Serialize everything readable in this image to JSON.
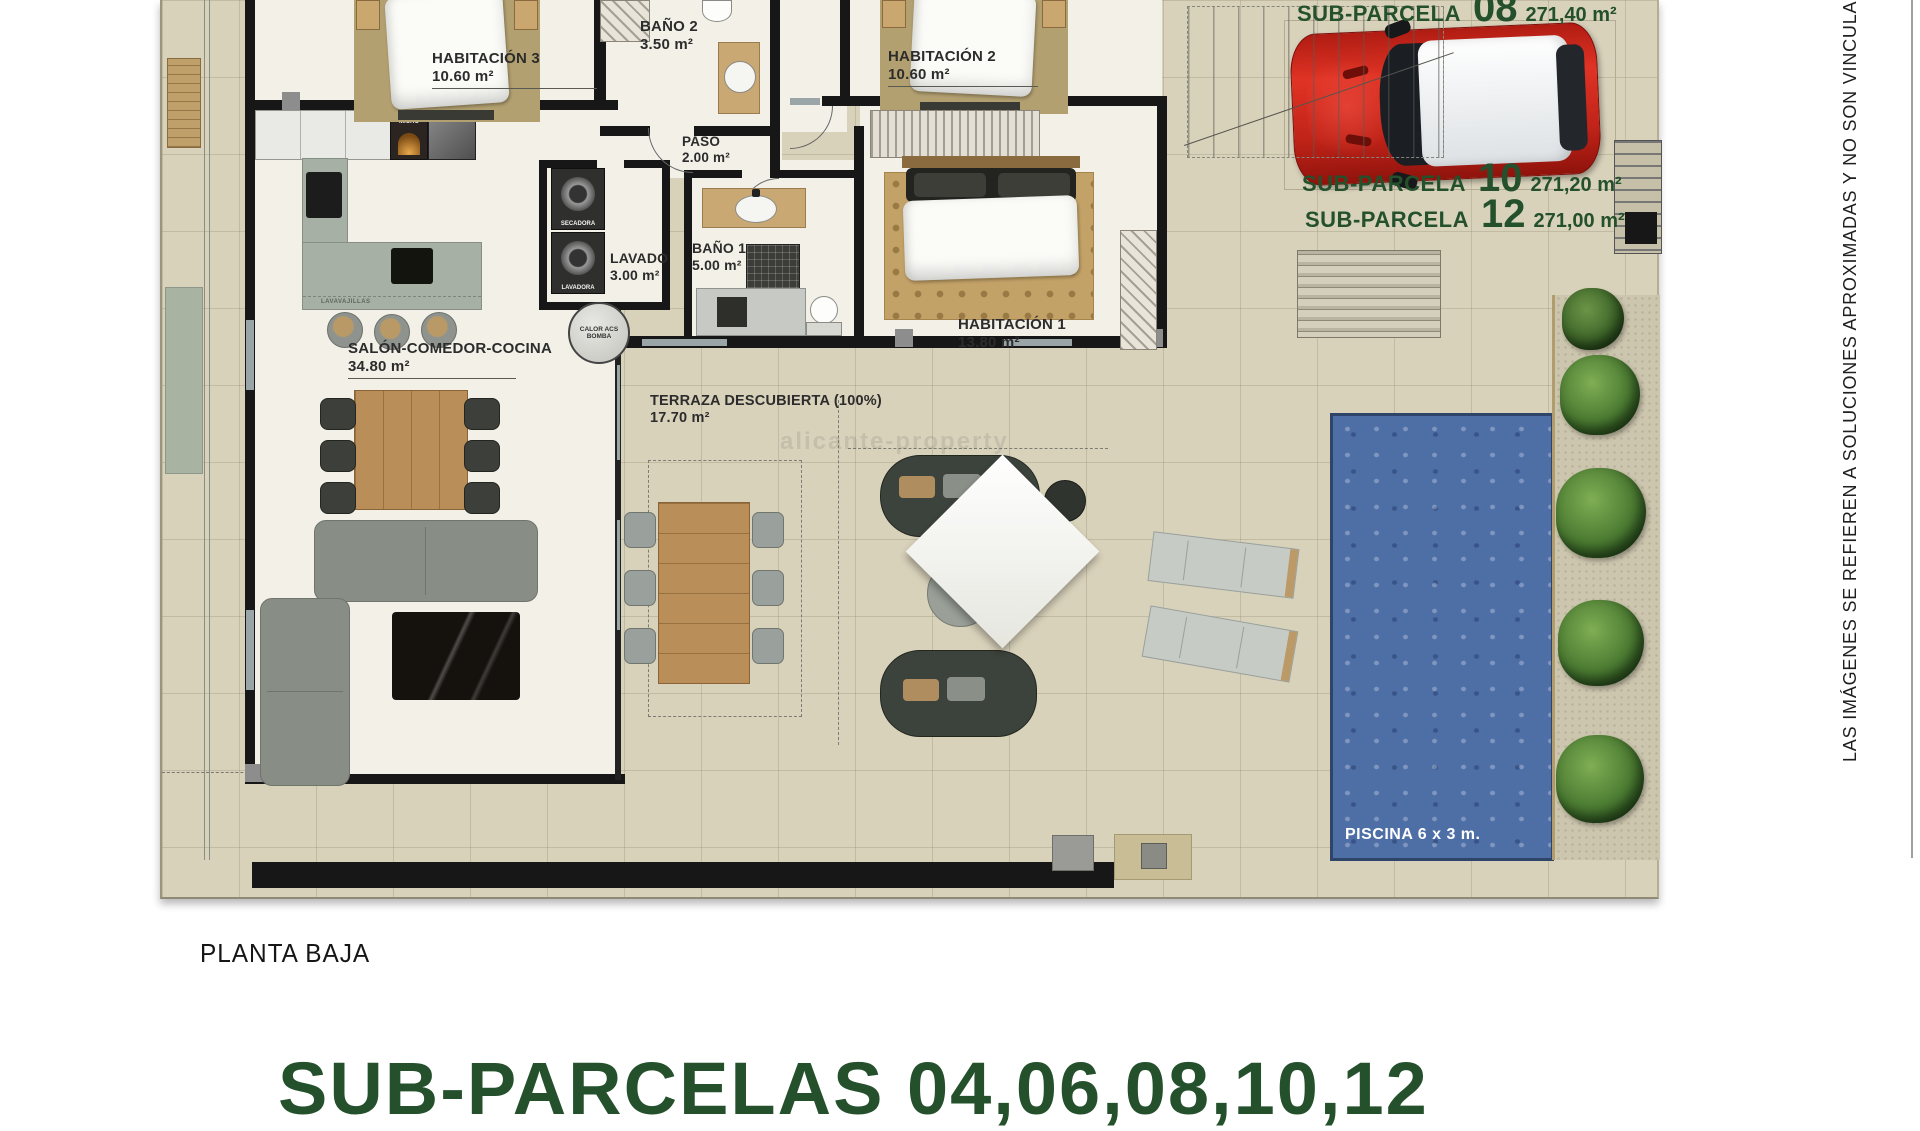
{
  "plan": {
    "floor_label": "PLANTA BAJA",
    "bottom_title": "SUB-PARCELAS 04,06,08,10,12",
    "disclaimer": "LAS IMÁGENES SE REFIEREN A SOLUCIONES APROXIMADAS Y NO SON VINCULANTES A",
    "watermark": "alicante-property"
  },
  "parcels": {
    "p08": {
      "label": "SUB-PARCELA",
      "number": "08",
      "area": "271,40 m²"
    },
    "p10": {
      "label": "SUB-PARCELA",
      "number": "10",
      "area": "271,20 m²"
    },
    "p12": {
      "label": "SUB-PARCELA",
      "number": "12",
      "area": "271,00 m²"
    }
  },
  "rooms": {
    "hab3": {
      "name": "HABITACIÓN 3",
      "area": "10.60 m²"
    },
    "bano2": {
      "name": "BAÑO 2",
      "area": "3.50 m²"
    },
    "hab2": {
      "name": "HABITACIÓN 2",
      "area": "10.60 m²"
    },
    "paso": {
      "name": "PASO",
      "area": "2.00 m²"
    },
    "lavado": {
      "name": "LAVADO",
      "area": "3.00 m²"
    },
    "bano1": {
      "name": "BAÑO 1",
      "area": "5.00 m²"
    },
    "hab1": {
      "name": "HABITACIÓN 1",
      "area": "13.80 m²"
    },
    "salon": {
      "name": "SALÓN-COMEDOR-COCINA",
      "area": "34.80 m²"
    },
    "terraza": {
      "name": "TERRAZA DESCUBIERTA (100%)",
      "area": "17.70 m²"
    }
  },
  "appliances": {
    "horno": "HORNO MICRO",
    "frigorifico": "FRIGORÍFICO",
    "lavavajillas": "LAVAVAJILLAS",
    "secadora": "SECADORA",
    "lavadora": "LAVADORA",
    "calor": "CALOR ACS BOMBA"
  },
  "pool": {
    "label": "PISCINA 6 x 3 m."
  },
  "colors": {
    "accent_green": "#24502c",
    "pool_blue": "#4e6ea6",
    "car_red": "#c8231b",
    "ground_beige": "#d9d2bb"
  }
}
